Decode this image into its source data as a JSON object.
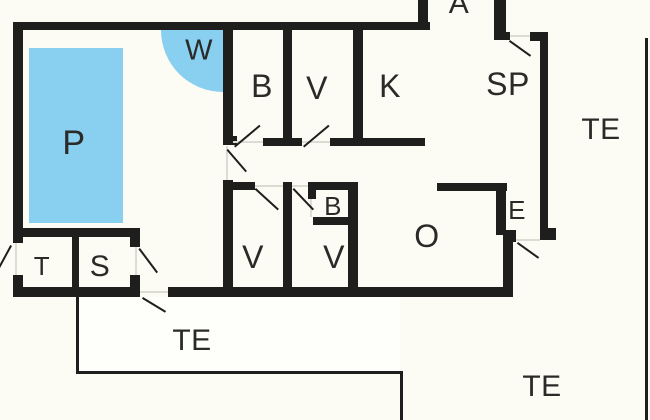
{
  "meta": {
    "drawing_type": "floor-plan",
    "canvas": {
      "width": 650,
      "height": 420
    },
    "colors": {
      "background": "#FCFCF4",
      "wall": "#1E1E1C",
      "pool": "#88CFF0",
      "label": "#2A2A28",
      "door_gap": "#DCDCD2",
      "terrace_fill": "#FEFEFB"
    }
  },
  "rooms": [
    {
      "id": "pool-room",
      "label": "P",
      "cx": 74,
      "cy": 143,
      "size": 34
    },
    {
      "id": "whirlpool",
      "label": "W",
      "cx": 199,
      "cy": 51,
      "size": 29
    },
    {
      "id": "bath-north",
      "label": "B",
      "cx": 262,
      "cy": 86,
      "size": 32
    },
    {
      "id": "bedroom-north",
      "label": "V",
      "cx": 317,
      "cy": 88,
      "size": 32
    },
    {
      "id": "kitchen",
      "label": "K",
      "cx": 390,
      "cy": 86,
      "size": 32
    },
    {
      "id": "sp-room",
      "label": "SP",
      "cx": 508,
      "cy": 84,
      "size": 32
    },
    {
      "id": "alcove",
      "label": "A",
      "cx": 459,
      "cy": 4,
      "size": 30
    },
    {
      "id": "terrace-east",
      "label": "TE",
      "cx": 601,
      "cy": 130,
      "size": 30
    },
    {
      "id": "entry",
      "label": "E",
      "cx": 517,
      "cy": 210,
      "size": 26
    },
    {
      "id": "living-room",
      "label": "O",
      "cx": 427,
      "cy": 236,
      "size": 32
    },
    {
      "id": "bath-small",
      "label": "B",
      "cx": 333,
      "cy": 206,
      "size": 26
    },
    {
      "id": "bedroom-sw",
      "label": "V",
      "cx": 253,
      "cy": 257,
      "size": 32
    },
    {
      "id": "bedroom-south",
      "label": "V",
      "cx": 334,
      "cy": 257,
      "size": 32
    },
    {
      "id": "toilet",
      "label": "T",
      "cx": 42,
      "cy": 266,
      "size": 26
    },
    {
      "id": "sauna",
      "label": "S",
      "cx": 100,
      "cy": 267,
      "size": 30
    },
    {
      "id": "terrace-south",
      "label": "TE",
      "cx": 192,
      "cy": 341,
      "size": 30
    },
    {
      "id": "terrace-southeast",
      "label": "TE",
      "cx": 542,
      "cy": 387,
      "size": 30
    }
  ],
  "pool": {
    "x": 29,
    "y": 48,
    "w": 94,
    "h": 175
  },
  "whirlpool_quarter": {
    "x": 161,
    "y": 30,
    "w": 62,
    "h": 62
  },
  "terrace_fill_south": {
    "x": 79,
    "y": 297,
    "w": 321,
    "h": 74
  },
  "walls": [
    {
      "name": "outer-top",
      "x": 13,
      "y": 22,
      "w": 417,
      "h": 8
    },
    {
      "name": "outer-left-upper",
      "x": 13,
      "y": 22,
      "w": 10,
      "h": 221
    },
    {
      "name": "outer-left-lower",
      "x": 13,
      "y": 275,
      "w": 10,
      "h": 22
    },
    {
      "name": "outer-bottom-west",
      "x": 13,
      "y": 287,
      "w": 127,
      "h": 10
    },
    {
      "name": "outer-bottom-main",
      "x": 168,
      "y": 287,
      "w": 345,
      "h": 10
    },
    {
      "name": "pool-east-upper",
      "x": 223,
      "y": 30,
      "w": 10,
      "h": 115
    },
    {
      "name": "pool-east-cap",
      "x": 223,
      "y": 136,
      "w": 14,
      "h": 9
    },
    {
      "name": "pool-east-lower",
      "x": 223,
      "y": 180,
      "w": 10,
      "h": 107
    },
    {
      "name": "b-v-divider-north",
      "x": 283,
      "y": 30,
      "w": 9,
      "h": 116
    },
    {
      "name": "v-k-divider",
      "x": 353,
      "y": 30,
      "w": 10,
      "h": 116
    },
    {
      "name": "bath-north-south-wall",
      "x": 263,
      "y": 138,
      "w": 39,
      "h": 8
    },
    {
      "name": "v-k-south-wall",
      "x": 330,
      "y": 138,
      "w": 95,
      "h": 8
    },
    {
      "name": "alcove-west",
      "x": 418,
      "y": 0,
      "w": 10,
      "h": 30
    },
    {
      "name": "alcove-east",
      "x": 494,
      "y": 0,
      "w": 12,
      "h": 33
    },
    {
      "name": "alcove-east-cap",
      "x": 494,
      "y": 32,
      "w": 16,
      "h": 8
    },
    {
      "name": "outer-right-cap-north",
      "x": 530,
      "y": 32,
      "w": 18,
      "h": 9
    },
    {
      "name": "outer-right",
      "x": 540,
      "y": 32,
      "w": 8,
      "h": 208
    },
    {
      "name": "outer-right-cap-south",
      "x": 540,
      "y": 228,
      "w": 16,
      "h": 12
    },
    {
      "name": "hall-south-wall-west",
      "x": 223,
      "y": 182,
      "w": 32,
      "h": 8
    },
    {
      "name": "v-v-divider-south",
      "x": 283,
      "y": 182,
      "w": 9,
      "h": 105
    },
    {
      "name": "bath-small-north",
      "x": 308,
      "y": 182,
      "w": 50,
      "h": 8
    },
    {
      "name": "bath-small-west-stub",
      "x": 308,
      "y": 182,
      "w": 8,
      "h": 17
    },
    {
      "name": "bath-small-south",
      "x": 313,
      "y": 217,
      "w": 45,
      "h": 8
    },
    {
      "name": "bedroom-south-east",
      "x": 348,
      "y": 182,
      "w": 10,
      "h": 105
    },
    {
      "name": "entry-north",
      "x": 437,
      "y": 183,
      "w": 70,
      "h": 8
    },
    {
      "name": "entry-west",
      "x": 496,
      "y": 191,
      "w": 10,
      "h": 44
    },
    {
      "name": "entry-corner-block",
      "x": 503,
      "y": 230,
      "w": 13,
      "h": 12
    },
    {
      "name": "living-east",
      "x": 503,
      "y": 242,
      "w": 10,
      "h": 55
    },
    {
      "name": "toilet-sauna-north",
      "x": 15,
      "y": 228,
      "w": 122,
      "h": 9
    },
    {
      "name": "toilet-sauna-divider",
      "x": 72,
      "y": 237,
      "w": 7,
      "h": 50
    },
    {
      "name": "sauna-east-upper",
      "x": 130,
      "y": 228,
      "w": 10,
      "h": 19
    },
    {
      "name": "sauna-east-lower",
      "x": 130,
      "y": 275,
      "w": 10,
      "h": 22
    }
  ],
  "terrace_lines": [
    {
      "name": "terrace-south-west-edge",
      "x": 76,
      "y": 297,
      "w": 3,
      "h": 77
    },
    {
      "name": "terrace-south-bottom-edge",
      "x": 76,
      "y": 371,
      "w": 327,
      "h": 3
    },
    {
      "name": "terrace-south-east-edge",
      "x": 400,
      "y": 371,
      "w": 3,
      "h": 49
    },
    {
      "name": "terrace-east-edge",
      "x": 645,
      "y": 38,
      "w": 3,
      "h": 382
    }
  ],
  "door_gap_lines": [
    {
      "name": "pool-door-gap",
      "x": 226,
      "y": 146,
      "w": 2,
      "h": 34
    },
    {
      "name": "toilet-door-gap",
      "x": 15,
      "y": 243,
      "w": 2,
      "h": 32
    },
    {
      "name": "sauna-door-gap",
      "x": 135,
      "y": 247,
      "w": 2,
      "h": 28
    },
    {
      "name": "bath-north-door-gap",
      "x": 233,
      "y": 141,
      "w": 30,
      "h": 2
    },
    {
      "name": "bedroom-north-door-gap",
      "x": 302,
      "y": 141,
      "w": 28,
      "h": 2
    },
    {
      "name": "bedroom-sw-door-gap",
      "x": 255,
      "y": 185,
      "w": 28,
      "h": 2
    },
    {
      "name": "bedroom-south-door-gap",
      "x": 292,
      "y": 185,
      "w": 16,
      "h": 2
    },
    {
      "name": "bath-small-door-gap",
      "x": 310,
      "y": 199,
      "w": 2,
      "h": 18
    },
    {
      "name": "terrace-door-gap",
      "x": 140,
      "y": 291,
      "w": 28,
      "h": 2
    },
    {
      "name": "entry-door-gap",
      "x": 516,
      "y": 239,
      "w": 24,
      "h": 2
    },
    {
      "name": "sp-door-gap",
      "x": 510,
      "y": 35,
      "w": 20,
      "h": 2
    }
  ],
  "door_leaves": [
    {
      "name": "bath-north-door-leaf",
      "x1": 234,
      "y1": 146,
      "x2": 259,
      "y2": 125
    },
    {
      "name": "bedroom-north-door-leaf",
      "x1": 303,
      "y1": 146,
      "x2": 328,
      "y2": 125
    },
    {
      "name": "pool-door-leaf",
      "x1": 228,
      "y1": 149,
      "x2": 247,
      "y2": 171
    },
    {
      "name": "bedroom-sw-door-leaf",
      "x1": 256,
      "y1": 188,
      "x2": 279,
      "y2": 209
    },
    {
      "name": "bedroom-south-door-leaf",
      "x1": 294,
      "y1": 188,
      "x2": 314,
      "y2": 209
    },
    {
      "name": "sauna-door-leaf",
      "x1": 140,
      "y1": 248,
      "x2": 158,
      "y2": 272
    },
    {
      "name": "toilet-door-leaf",
      "x1": 12,
      "y1": 246,
      "x2": 0,
      "y2": 268
    },
    {
      "name": "terrace-door-leaf",
      "x1": 143,
      "y1": 297,
      "x2": 166,
      "y2": 311
    },
    {
      "name": "entry-door-leaf",
      "x1": 518,
      "y1": 242,
      "x2": 539,
      "y2": 257
    },
    {
      "name": "sp-door-leaf",
      "x1": 510,
      "y1": 40,
      "x2": 531,
      "y2": 55
    }
  ]
}
